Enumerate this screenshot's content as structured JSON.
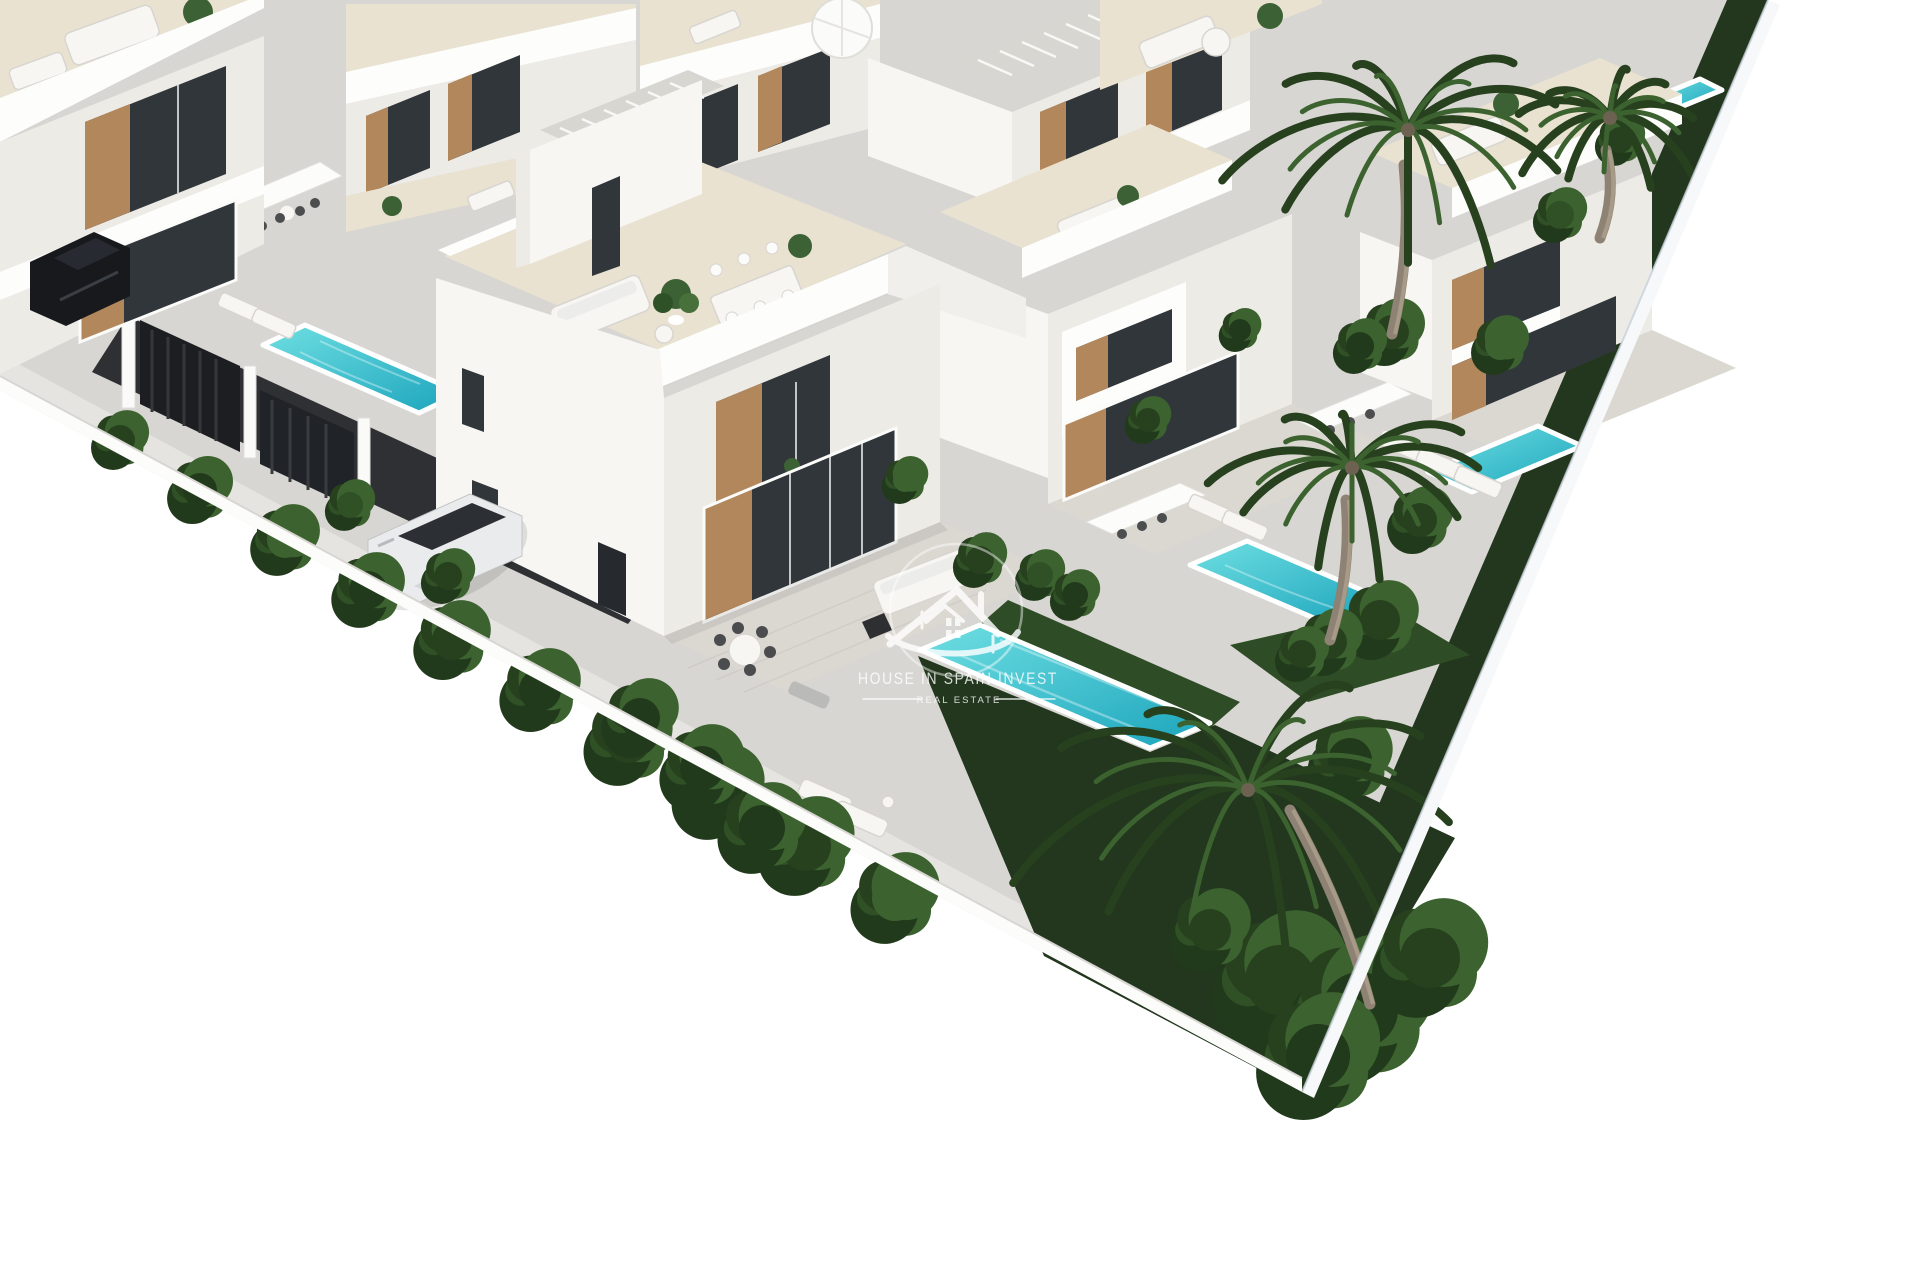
{
  "watermark": {
    "title": "HOUSE IN SPAIN INVEST",
    "subtitle": "REAL ESTATE",
    "icon": "house-logo-icon"
  },
  "scene": {
    "type": "architectural-render",
    "description": "Aerial 3D visualization of a modern white villa development with private turquoise pools, grey paved terraces, dark lawns, palm trees, perimeter wall, parked SUVs and dark entrance gates"
  },
  "colors": {
    "background": "#ffffff",
    "pavement": "#d8d6d2",
    "sidewalk": "#e6e4e0",
    "patio": "#dbd8d2",
    "terrace_floor": "#eae2d1",
    "street": "#2f3033",
    "gate": "#1c1e21",
    "villa_bright": "#f7f6f3",
    "villa_band": "#fdfdfc",
    "villa_shade": "#edebe6",
    "glass": "#31363b",
    "wood": "#b3875c",
    "pool_light": "#6fdfe2",
    "pool_deep": "#1ba4bc",
    "lawn": "#22371d",
    "lawn_light": "#2e4c26",
    "palm_dark": "#27411f",
    "palm_light": "#3c632f",
    "trunk": "#8d8273",
    "wall_edge": "#c8d1da",
    "car_dark": "#17191d",
    "car_white": "#e9ebec",
    "watermark": "#ffffff"
  }
}
